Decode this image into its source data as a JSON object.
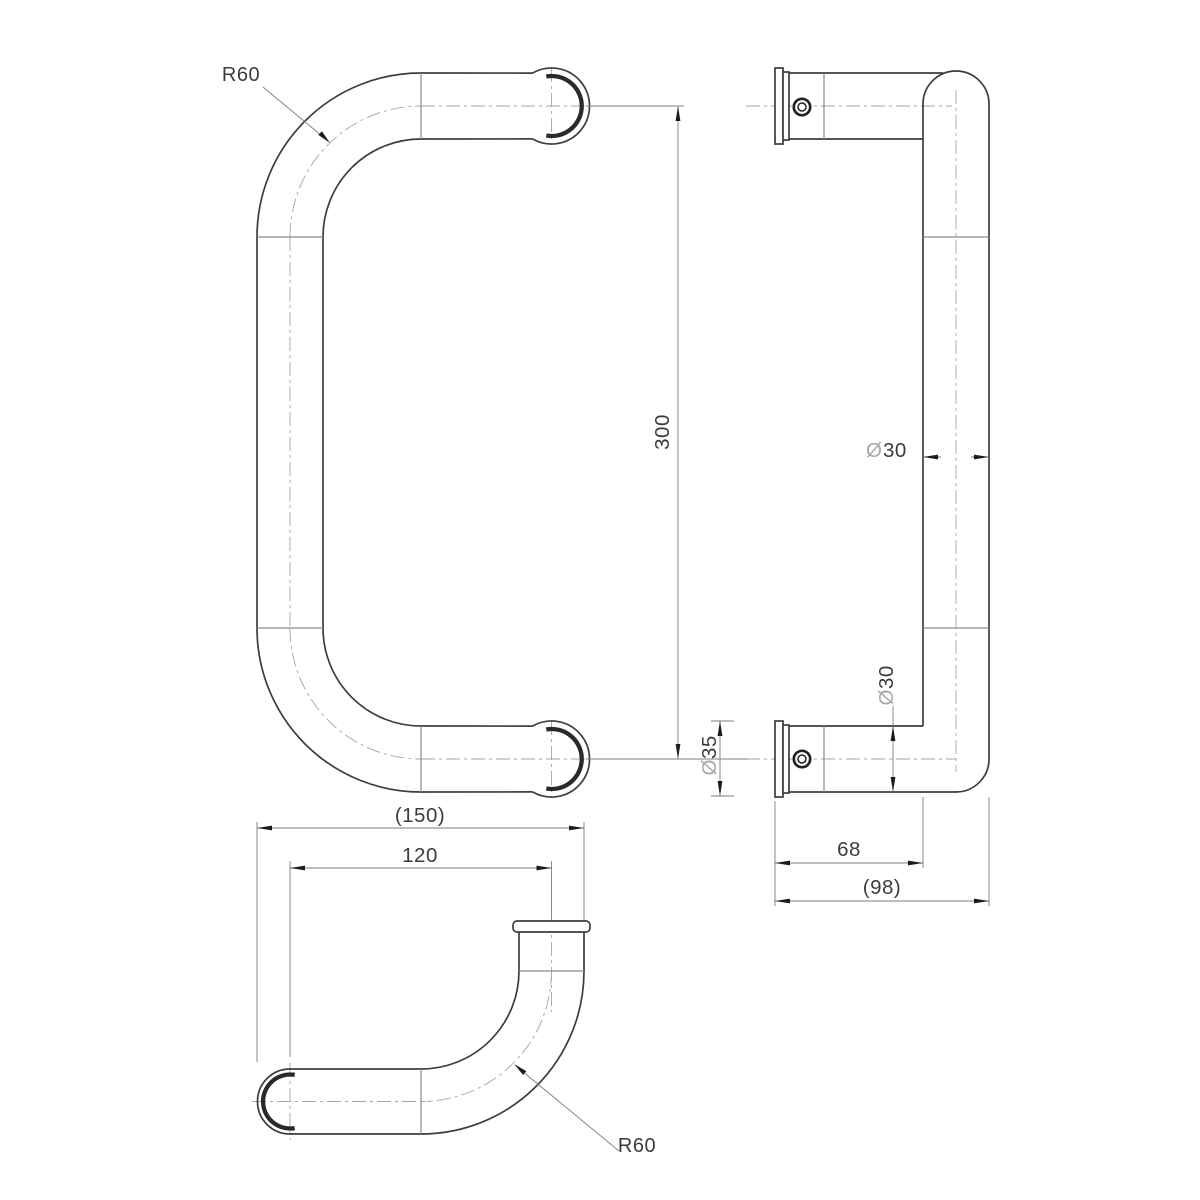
{
  "drawing_labels": {
    "front": {
      "bend_radius": "R60"
    },
    "side": {
      "grip_length": "300",
      "dia_symbol": "Ø",
      "grip_tube_dia": "30",
      "leg_tube_dia": "30",
      "rose_dia": "35",
      "projection": "68",
      "overall_projection": "(98)"
    },
    "top": {
      "bend_radius": "R60",
      "centres": "120",
      "overall_width": "(150)"
    }
  }
}
